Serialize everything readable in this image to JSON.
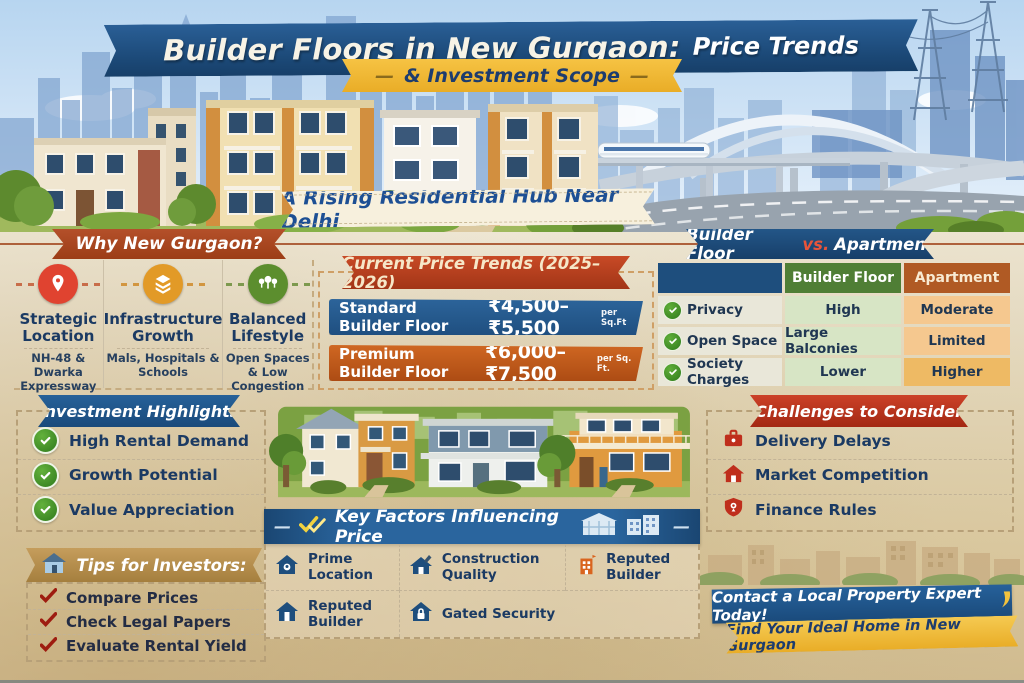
{
  "decor": {
    "dash": "—"
  },
  "header": {
    "title_main": "Builder Floors in New Gurgaon:",
    "title_accent": "Price Trends",
    "subtitle": "& Investment Scope",
    "tagline": "A Rising Residential Hub Near Delhi"
  },
  "why": {
    "heading": "Why New Gurgaon?",
    "items": [
      {
        "icon": "location-pin-icon",
        "title": "Strategic Location",
        "subtitle": "NH-48 & Dwarka Expressway",
        "color": "#e04330"
      },
      {
        "icon": "layers-icon",
        "title": "Infrastructure Growth",
        "subtitle": "Mals, Hospitals & Schools",
        "color": "#e29a27"
      },
      {
        "icon": "trees-icon",
        "title": "Balanced Lifestyle",
        "subtitle": "Open Spaces & Low Congestion",
        "color": "#5c8e2e"
      }
    ]
  },
  "price_trends": {
    "heading": "Current Price Trends (2025–2026)",
    "rows": [
      {
        "label": "Standard Builder Floor",
        "range": "₹4,500–₹5,500",
        "unit": "per Sq.Ft",
        "color": "#24598a"
      },
      {
        "label": "Premium Builder Floor",
        "range": "₹6,000–₹7,500",
        "unit": "per Sq. Ft.",
        "color": "#bf5a1e"
      }
    ]
  },
  "comparison": {
    "heading": {
      "left": "Builder Floor",
      "vs": "vs.",
      "right": "Apartment"
    },
    "col_headers": [
      "Builder Floor",
      "Apartment"
    ],
    "rows": [
      {
        "feature": "Privacy",
        "builder_floor": "High",
        "apartment": "Moderate"
      },
      {
        "feature": "Open Space",
        "builder_floor": "Large Balconies",
        "apartment": "Limited"
      },
      {
        "feature": "Society Charges",
        "builder_floor": "Lower",
        "apartment": "Higher"
      }
    ]
  },
  "investment": {
    "heading": "Investment Highlights",
    "items": [
      "High Rental Demand",
      "Growth Potential",
      "Value Appreciation"
    ]
  },
  "challenges": {
    "heading": "Challenges to Consider",
    "items": [
      {
        "icon": "briefcase-icon",
        "label": "Delivery Delays"
      },
      {
        "icon": "house-icon",
        "label": "Market Competition"
      },
      {
        "icon": "shield-pin-icon",
        "label": "Finance Rules"
      }
    ]
  },
  "key_factors": {
    "heading": "Key Factors Influencing Price",
    "items": [
      {
        "icon": "house-location-icon",
        "label": "Prime Location"
      },
      {
        "icon": "house-construction-icon",
        "label": "Construction Quality"
      },
      {
        "icon": "building-flag-icon",
        "label": "Reputed Builder"
      },
      {
        "icon": "house-icon",
        "label": "Reputed Builder"
      },
      {
        "icon": "house-lock-icon",
        "label": "Gated Security"
      }
    ]
  },
  "tips": {
    "heading": "Tips for Investors:",
    "items": [
      "Compare Prices",
      "Check Legal Papers",
      "Evaluate Rental Yield"
    ]
  },
  "cta": {
    "line1": "Contact a Local Property Expert Today!",
    "line2": "Find Your Ideal Home in New Gurgaon"
  },
  "colors": {
    "accent_blue": "#1d5083",
    "accent_red": "#b93a20",
    "accent_rust": "#a8431c",
    "accent_gold": "#eeb62f",
    "table_green": "#4f7e35",
    "table_orange": "#b05a24"
  }
}
